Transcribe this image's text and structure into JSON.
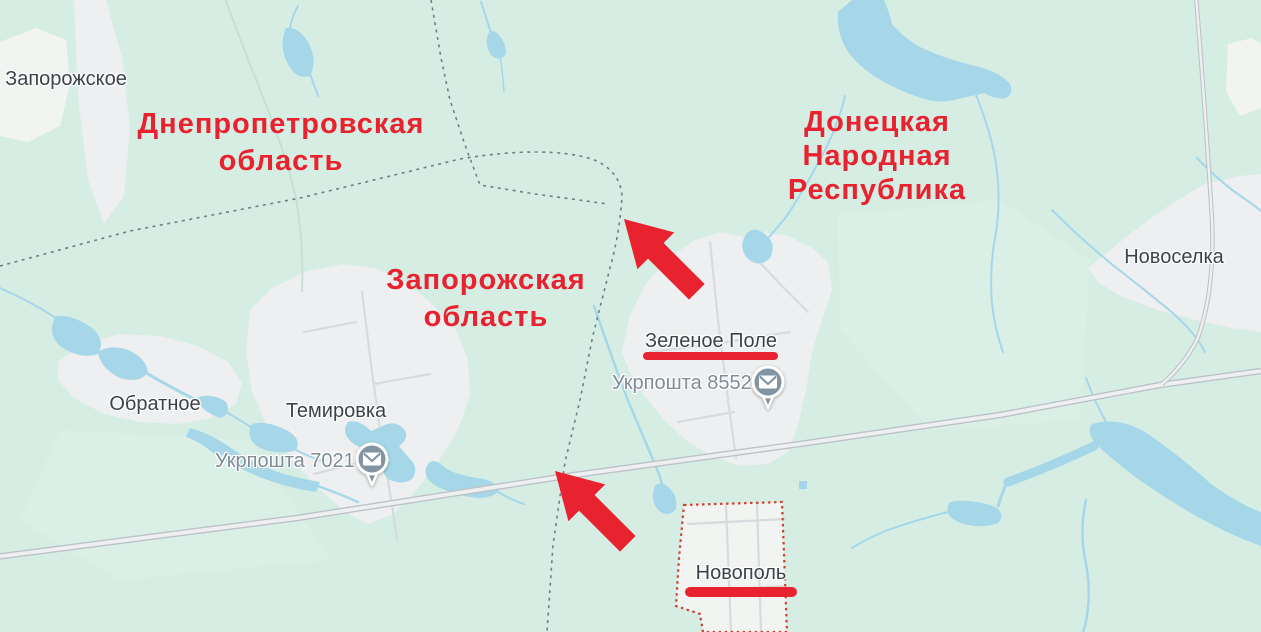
{
  "regions": {
    "dnipropetrovsk": {
      "line1": "Днепропетровская",
      "line2": "область"
    },
    "zaporizhzhia": {
      "line1": "Запорожская",
      "line2": "область"
    },
    "donetsk": {
      "line1": "Донецкая",
      "line2": "Народная",
      "line3": "Республика"
    }
  },
  "places": {
    "zaporozhskoe": "Запорожское",
    "novoselka": "Новоселка",
    "obratnoe": "Обратное",
    "temirovka": "Темировка",
    "zelenoe_pole": "Зеленое Поле",
    "novopol": "Новополь"
  },
  "post_offices": {
    "zelenoe_pole": "Укрпошта 85525",
    "temirovka": "Укрпошта 70210"
  },
  "colors": {
    "land": "#d6ede4",
    "land_light": "#def3ea",
    "water": "#a6d7e8",
    "urban": "#edeff0",
    "urban_line": "#d8dbde",
    "field": "#f2f4f2",
    "road_casing": "#bcc2c7",
    "road_fill": "#edeff0",
    "boundary": "#6e767c",
    "novopol_border": "#cc4331",
    "annotation_red": "#e8222f",
    "label_dark": "#3d4248",
    "label_muted": "#7d8c96",
    "pin": "#8294a2"
  }
}
